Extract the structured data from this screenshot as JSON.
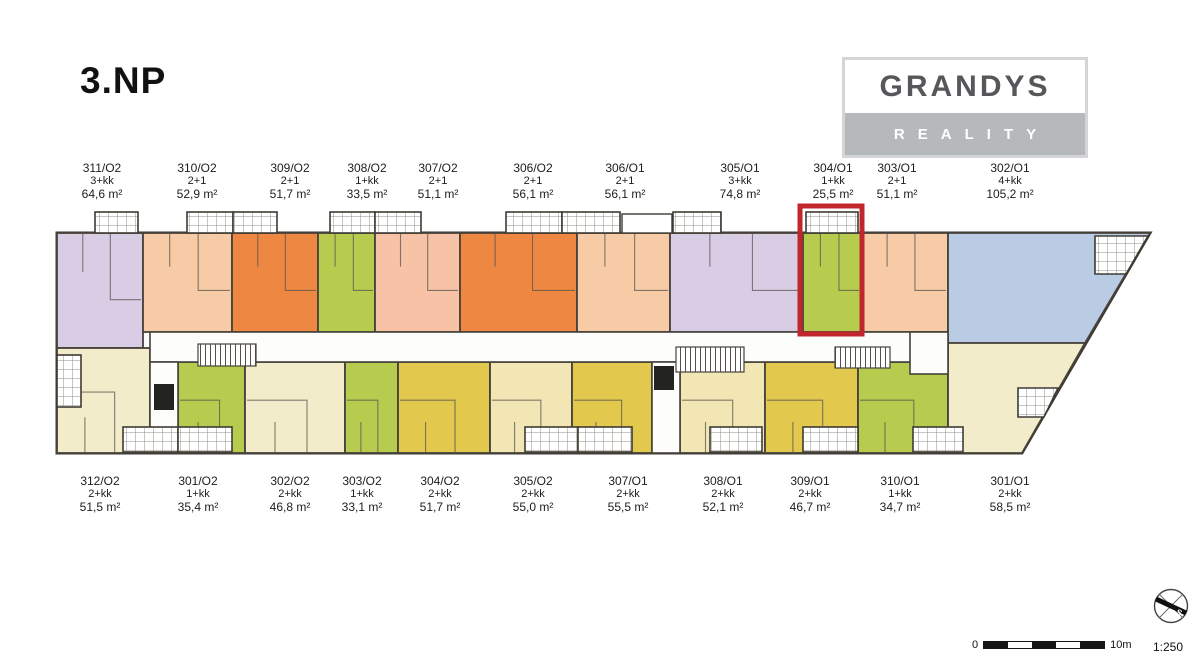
{
  "title": "3.NP",
  "logo": {
    "name": "GRANDYS",
    "subtitle": "REALITY"
  },
  "palette": {
    "lilac": "#d9cde6",
    "peach": "#f6cba6",
    "orange": "#ee8742",
    "green": "#b7cc4f",
    "salmon": "#f8c2a6",
    "blue": "#b9cce4",
    "cream": "#f3ecca",
    "pale": "#f2e7b4",
    "mustard": "#e2c94e",
    "highlight": "#c0262b",
    "wall": "#46423b"
  },
  "plan": {
    "highlighted_unit": "304/O1",
    "top_units": [
      {
        "id": "311/O2",
        "layout": "3+kk",
        "area": "64,6 m²",
        "color": "lilac",
        "x": 57,
        "y": 233,
        "w": 86,
        "h": 115,
        "label_x": 102
      },
      {
        "id": "310/O2",
        "layout": "2+1",
        "area": "52,9 m²",
        "color": "peach",
        "x": 143,
        "y": 233,
        "w": 89,
        "h": 99,
        "label_x": 197
      },
      {
        "id": "309/O2",
        "layout": "2+1",
        "area": "51,7 m²",
        "color": "orange",
        "x": 232,
        "y": 233,
        "w": 86,
        "h": 99,
        "label_x": 290
      },
      {
        "id": "308/O2",
        "layout": "1+kk",
        "area": "33,5 m²",
        "color": "green",
        "x": 318,
        "y": 233,
        "w": 57,
        "h": 99,
        "label_x": 367
      },
      {
        "id": "307/O2",
        "layout": "2+1",
        "area": "51,1 m²",
        "color": "salmon",
        "x": 375,
        "y": 233,
        "w": 85,
        "h": 99,
        "label_x": 438
      },
      {
        "id": "306/O2",
        "layout": "2+1",
        "area": "56,1 m²",
        "color": "orange",
        "x": 460,
        "y": 233,
        "w": 117,
        "h": 99,
        "label_x": 533
      },
      {
        "id": "306/O1",
        "layout": "2+1",
        "area": "56,1 m²",
        "color": "peach",
        "x": 577,
        "y": 233,
        "w": 93,
        "h": 99,
        "label_x": 625
      },
      {
        "id": "305/O1",
        "layout": "3+kk",
        "area": "74,8 m²",
        "color": "lilac",
        "x": 670,
        "y": 233,
        "w": 133,
        "h": 99,
        "label_x": 740
      },
      {
        "id": "304/O1",
        "layout": "1+kk",
        "area": "25,5 m²",
        "color": "green",
        "x": 803,
        "y": 233,
        "w": 58,
        "h": 99,
        "label_x": 833,
        "highlighted": true
      },
      {
        "id": "303/O1",
        "layout": "2+1",
        "area": "51,1 m²",
        "color": "peach",
        "x": 861,
        "y": 233,
        "w": 87,
        "h": 99,
        "label_x": 897
      },
      {
        "id": "302/O1",
        "layout": "4+kk",
        "area": "105,2 m²",
        "color": "blue",
        "poly": [
          [
            948,
            233
          ],
          [
            1150,
            233
          ],
          [
            1085,
            343
          ],
          [
            948,
            343
          ]
        ],
        "label_x": 1010
      }
    ],
    "bottom_units": [
      {
        "id": "312/O2",
        "layout": "2+kk",
        "area": "51,5 m²",
        "color": "cream",
        "x": 57,
        "y": 348,
        "w": 93,
        "h": 105,
        "label_x": 100
      },
      {
        "id": "301/O2",
        "layout": "1+kk",
        "area": "35,4 m²",
        "color": "green",
        "x": 178,
        "y": 362,
        "w": 67,
        "h": 91,
        "label_x": 198
      },
      {
        "id": "302/O2",
        "layout": "2+kk",
        "area": "46,8 m²",
        "color": "cream",
        "x": 245,
        "y": 362,
        "w": 100,
        "h": 91,
        "label_x": 290
      },
      {
        "id": "303/O2",
        "layout": "1+kk",
        "area": "33,1 m²",
        "color": "green",
        "x": 345,
        "y": 362,
        "w": 53,
        "h": 91,
        "label_x": 362
      },
      {
        "id": "304/O2",
        "layout": "2+kk",
        "area": "51,7 m²",
        "color": "mustard",
        "x": 398,
        "y": 362,
        "w": 92,
        "h": 91,
        "label_x": 440
      },
      {
        "id": "305/O2",
        "layout": "2+kk",
        "area": "55,0 m²",
        "color": "pale",
        "x": 490,
        "y": 362,
        "w": 82,
        "h": 91,
        "label_x": 533
      },
      {
        "id": "307/O1",
        "layout": "2+kk",
        "area": "55,5 m²",
        "color": "mustard",
        "x": 572,
        "y": 362,
        "w": 80,
        "h": 91,
        "label_x": 628
      },
      {
        "id": "308/O1",
        "layout": "2+kk",
        "area": "52,1 m²",
        "color": "pale",
        "x": 680,
        "y": 362,
        "w": 85,
        "h": 91,
        "label_x": 723
      },
      {
        "id": "309/O1",
        "layout": "2+kk",
        "area": "46,7 m²",
        "color": "mustard",
        "x": 765,
        "y": 362,
        "w": 93,
        "h": 91,
        "label_x": 810
      },
      {
        "id": "310/O1",
        "layout": "1+kk",
        "area": "34,7 m²",
        "color": "green",
        "x": 858,
        "y": 362,
        "w": 90,
        "h": 91,
        "label_x": 900
      },
      {
        "id": "301/O1",
        "layout": "2+kk",
        "area": "58,5 m²",
        "color": "cream",
        "poly": [
          [
            948,
            343
          ],
          [
            1085,
            343
          ],
          [
            1022,
            453
          ],
          [
            948,
            453
          ]
        ],
        "label_x": 1010
      }
    ]
  },
  "footer": {
    "scale_start": "0",
    "scale_end": "10m",
    "ratio": "1:250",
    "compass_s": "S"
  }
}
